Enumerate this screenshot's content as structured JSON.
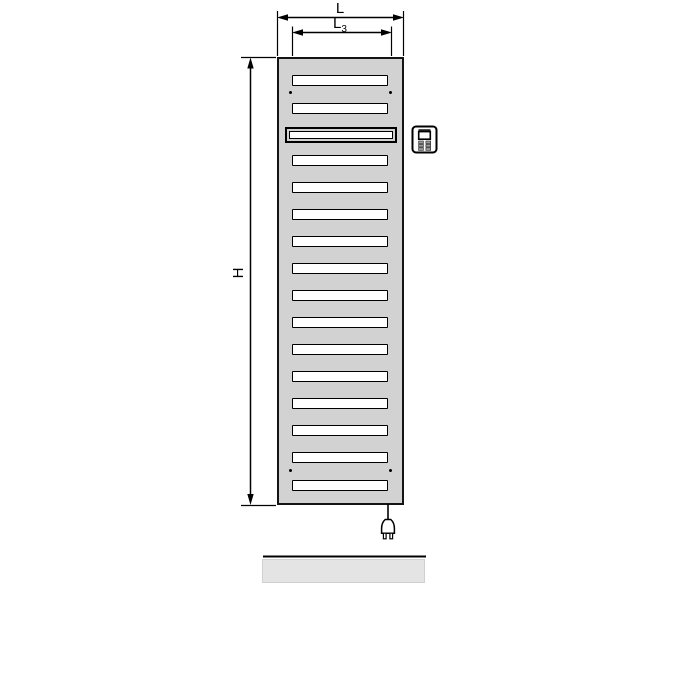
{
  "diagram": {
    "kind": "radiator-dimension-drawing",
    "labels": {
      "width": "L",
      "inner_width_base": "L",
      "inner_width_sub": "3",
      "height": "H"
    },
    "radiator": {
      "slots": [
        {
          "top": 16,
          "type": "normal"
        },
        {
          "top": 44,
          "type": "normal"
        },
        {
          "top": 68,
          "type": "panel"
        },
        {
          "top": 96,
          "type": "normal"
        },
        {
          "top": 123,
          "type": "normal"
        },
        {
          "top": 150,
          "type": "normal"
        },
        {
          "top": 177,
          "type": "normal"
        },
        {
          "top": 204,
          "type": "normal"
        },
        {
          "top": 231,
          "type": "normal"
        },
        {
          "top": 258,
          "type": "normal"
        },
        {
          "top": 285,
          "type": "normal"
        },
        {
          "top": 312,
          "type": "normal"
        },
        {
          "top": 339,
          "type": "normal"
        },
        {
          "top": 366,
          "type": "normal"
        },
        {
          "top": 393,
          "type": "normal"
        },
        {
          "top": 421,
          "type": "normal"
        }
      ],
      "screws": [
        {
          "x": 10,
          "y": 32
        },
        {
          "x": 110,
          "y": 32
        },
        {
          "x": 10,
          "y": 410
        },
        {
          "x": 110,
          "y": 410
        }
      ]
    },
    "colors": {
      "radiator_fill": "#d2d2d2",
      "slot_fill": "#ffffff",
      "outline": "#000000",
      "floor_fill": "#e4e4e4"
    },
    "icons": [
      "control-unit-icon",
      "power-plug-icon"
    ]
  }
}
